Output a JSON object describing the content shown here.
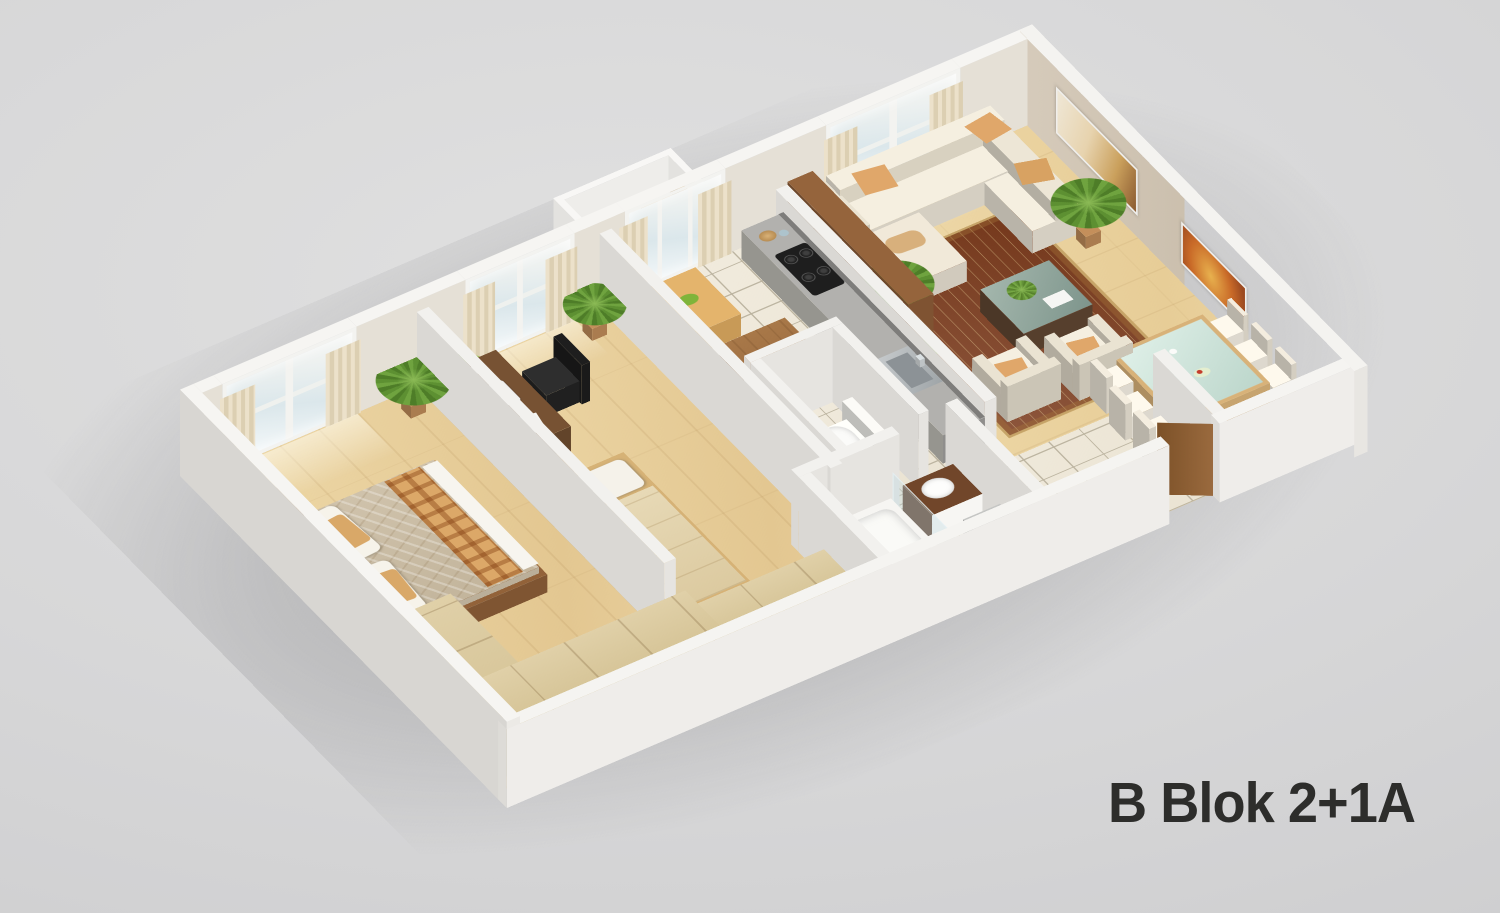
{
  "title": "B Blok 2+1A",
  "colors": {
    "background": "#d4d4d5",
    "title_text": "#2d2d2b",
    "wall_top": "#f6f5f2",
    "wall_exterior": "#d8d6d2",
    "wall_interior_beige": "#cdc1b0",
    "floor_wood": "#e7d2a0",
    "floor_tile": "#f0eadc",
    "rug": "#d8b87e",
    "rug_motif": "#7a3a1c",
    "sofa": "#e7e1d3",
    "accent_cushion": "#e0a76a",
    "kitchen_counter": "#a3a2a0",
    "wood_furniture": "#8a5c36",
    "plant_green": "#5d9032"
  },
  "scene": {
    "label": "3D isometric apartment floor plan render",
    "rooms": [
      {
        "name": "master-bedroom",
        "furniture": [
          "double-bed",
          "pillows",
          "patterned-throw",
          "nightstand",
          "table-lamp",
          "l-shaped-wardrobe",
          "curtained-window",
          "palm-plant"
        ]
      },
      {
        "name": "second-bedroom",
        "furniture": [
          "desk",
          "laptop",
          "desk-lamp",
          "office-chair",
          "single-bed",
          "dresser-chest",
          "stool",
          "curtained-window",
          "palm-plant",
          "fern-plant"
        ]
      },
      {
        "name": "wc",
        "furniture": [
          "toilet",
          "waste-bin"
        ]
      },
      {
        "name": "bathroom",
        "furniture": [
          "bathtub",
          "shower-glass-screen",
          "vanity-sink",
          "washing-machine"
        ]
      },
      {
        "name": "kitchen",
        "furniture": [
          "gray-counter",
          "gas-hob",
          "sink",
          "wood-island",
          "breakfast-table",
          "wooden-chairs",
          "bar-cabinet",
          "balcony-door"
        ]
      },
      {
        "name": "balcony",
        "furniture": [
          "bistro-table",
          "fruit-bowl",
          "wicker-chair",
          "railing"
        ]
      },
      {
        "name": "living-room",
        "furniture": [
          "sectional-sofa",
          "patterned-rug",
          "coffee-table",
          "two-armchairs",
          "palm-plants",
          "wall-art-beige",
          "wall-art-red",
          "curtained-window",
          "green-vase"
        ]
      },
      {
        "name": "dining-area",
        "furniture": [
          "glass-dining-table",
          "six-chairs",
          "tea-set",
          "fruit-bowl",
          "sideboard",
          "speaker"
        ]
      },
      {
        "name": "hallway",
        "furniture": [
          "console-table",
          "entry-door"
        ]
      }
    ]
  }
}
